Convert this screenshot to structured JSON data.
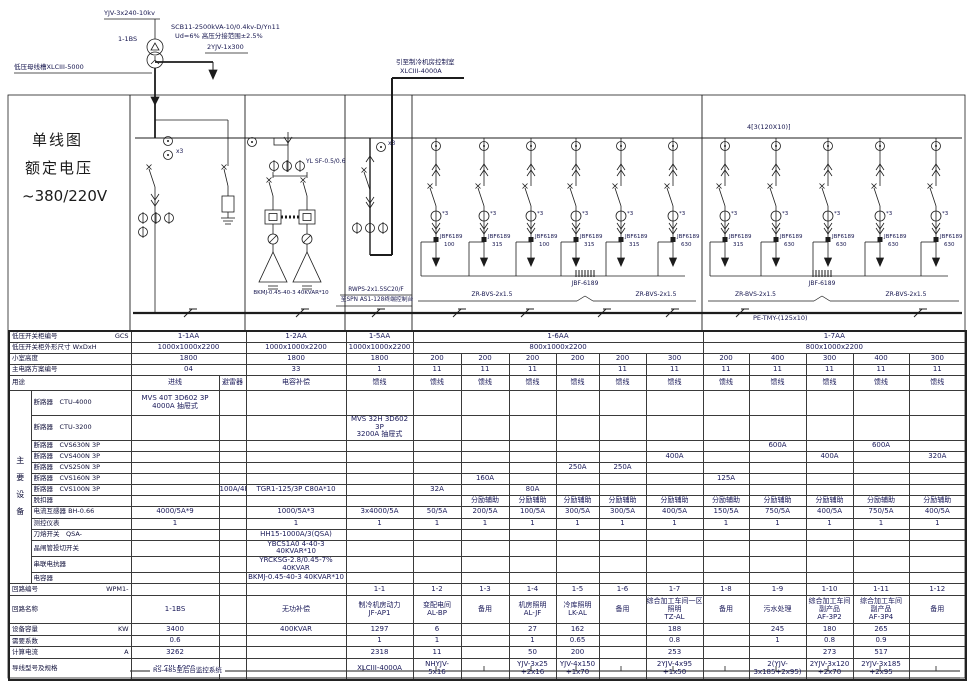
{
  "top": {
    "cable_hv": "YJV-3x240-10kv",
    "transformer_id": "1-1BS",
    "transformer_spec1": "SCB11-2500kVA-10/0.4kv-D/Yn11",
    "transformer_spec2": "Ud=6%  高压分接范围±2.5%",
    "cable_n": "2YJV-1x300",
    "busway": "低压母线槽XLCIII-5000",
    "to_chiller_1": "引至制冷机房控制室",
    "to_chiller_2": "XLCIII-4000A"
  },
  "panel_title": {
    "l1": "单线图",
    "l2": "额定电压",
    "l3": "~380/220V"
  },
  "schematic": {
    "meter_x3": "x3",
    "ct_x3": "*3",
    "yl_label": "YL SF-0.5/0.6",
    "cap_bottom_label": "BKMJ-0.45-40-3 40KVAR*10",
    "rwps_1": "RWPS-2x1.5SC20/F",
    "rwps_2": "至SPN AS1-128终端控制台",
    "zr_bvs": "ZR-BVS-2x1.5",
    "jbf_brace": "JBF-6189",
    "breaker_model": "JBF6189",
    "pe_bus": "PE-TMY-(125x10)",
    "bus_label_17aa": "4[3(120X10)]",
    "feeder_units_16aa": [
      "100",
      "315",
      "100",
      "315",
      "315",
      "630"
    ],
    "feeder_units_17aa": [
      "315",
      "630",
      "630",
      "630",
      "630"
    ]
  },
  "table": {
    "group_label": "主\n要\n设\n备",
    "col_widths": [
      22,
      100,
      88,
      27,
      100,
      67,
      48,
      48,
      47,
      43,
      47,
      57,
      46,
      57,
      47,
      56,
      57
    ],
    "rows": [
      {
        "h": 11,
        "label": "低压开关柜编号",
        "sub": "GCS",
        "cells": [
          [
            "1-1AA",
            2
          ],
          "1-2AA",
          "1-5AA",
          [
            "1-6AA",
            6
          ],
          [
            "1-7AA",
            5
          ]
        ]
      },
      {
        "h": 11,
        "label": "低压开关柜外形尺寸 WxDxH",
        "cells": [
          [
            "1000x1000x2200",
            2
          ],
          "1000x1000x2200",
          "1000x1000x2200",
          [
            "800x1000x2200",
            6
          ],
          [
            "800x1000x2200",
            5
          ]
        ]
      },
      {
        "h": 11,
        "label": "小室高度",
        "cells": [
          [
            "1800",
            2
          ],
          "1800",
          "1800",
          "200",
          "200",
          "200",
          "200",
          "200",
          "300",
          "200",
          "400",
          "300",
          "400",
          "300"
        ]
      },
      {
        "h": 11,
        "label": "主电路方案编号",
        "cells": [
          [
            "04",
            2
          ],
          "33",
          "1",
          "11",
          "11",
          "11",
          "",
          "11",
          "11",
          "11",
          "11",
          "11",
          "11",
          "11"
        ]
      },
      {
        "h": 15,
        "label": "用途",
        "cells": [
          "进线",
          "避雷器",
          "电容补偿",
          "馈线",
          "馈线",
          "馈线",
          "馈线",
          "馈线",
          "馈线",
          "馈线",
          "馈线",
          "馈线",
          "馈线",
          "馈线",
          "馈线"
        ]
      },
      {
        "h": 25,
        "g": true,
        "label": "断路器　CTU-4000",
        "cells": [
          "MVS 40T 3D602 3P\n4000A 抽屉式",
          "",
          "",
          "",
          "",
          "",
          "",
          "",
          "",
          "",
          "",
          "",
          "",
          "",
          ""
        ]
      },
      {
        "h": 25,
        "g": true,
        "label": "断路器　CTU-3200",
        "cells": [
          "",
          "",
          "",
          "MVS 32H 3D602 3P\n3200A 抽屉式",
          "",
          "",
          "",
          "",
          "",
          "",
          "",
          "",
          "",
          "",
          ""
        ]
      },
      {
        "h": 11,
        "g": true,
        "label": "断路器　CVS630N 3P",
        "cells": [
          "",
          "",
          "",
          "",
          "",
          "",
          "",
          "",
          "",
          "",
          "",
          "600A",
          "",
          "600A",
          ""
        ]
      },
      {
        "h": 11,
        "g": true,
        "label": "断路器　CVS400N 3P",
        "cells": [
          "",
          "",
          "",
          "",
          "",
          "",
          "",
          "",
          "",
          "400A",
          "",
          "",
          "400A",
          "",
          "320A"
        ]
      },
      {
        "h": 11,
        "g": true,
        "label": "断路器　CVS250N 3P",
        "cells": [
          "",
          "",
          "",
          "",
          "",
          "",
          "",
          "250A",
          "250A",
          "",
          "",
          "",
          "",
          "",
          ""
        ]
      },
      {
        "h": 11,
        "g": true,
        "label": "断路器　CVS160N 3P",
        "cells": [
          "",
          "",
          "",
          "",
          "",
          "160A",
          "",
          "",
          "",
          "",
          "125A",
          "",
          "",
          "",
          ""
        ]
      },
      {
        "h": 11,
        "g": true,
        "label": "断路器　CVS100N 3P",
        "cells": [
          "",
          "100A/4P",
          "TGR1-125/3P C80A*10",
          "",
          "32A",
          "",
          "80A",
          "",
          "",
          "",
          "",
          "",
          "",
          "",
          ""
        ]
      },
      {
        "h": 11,
        "g": true,
        "label": "脱扣器",
        "cells": [
          "",
          "",
          "",
          "",
          "",
          "分励辅助",
          "分励辅助",
          "分励辅助",
          "分励辅助",
          "分励辅助",
          "分励辅助",
          "分励辅助",
          "分励辅助",
          "分励辅助",
          "分励辅助"
        ]
      },
      {
        "h": 12,
        "g": true,
        "label": "电流互感器 BH-0.66",
        "cells": [
          "4000/5A*9",
          "",
          "1000/5A*3",
          "3x4000/5A",
          "50/5A",
          "200/5A",
          "100/5A",
          "300/5A",
          "300/5A",
          "400/5A",
          "150/5A",
          "750/5A",
          "400/5A",
          "750/5A",
          "400/5A"
        ]
      },
      {
        "h": 11,
        "g": true,
        "label": "测控仪表",
        "cells": [
          "1",
          "",
          "1",
          "1",
          "1",
          "1",
          "1",
          "1",
          "1",
          "1",
          "1",
          "1",
          "1",
          "1",
          "1"
        ]
      },
      {
        "h": 11,
        "g": true,
        "label": "刀熔开关　QSA-",
        "cells": [
          "",
          "",
          "HH15-1000A/3(QSA)",
          "",
          "",
          "",
          "",
          "",
          "",
          "",
          "",
          "",
          "",
          "",
          ""
        ]
      },
      {
        "h": 11,
        "g": true,
        "label": "晶闸管投切开关",
        "cells": [
          "",
          "",
          "YBCS1A0 4-40-3 40KVAR*10",
          "",
          "",
          "",
          "",
          "",
          "",
          "",
          "",
          "",
          "",
          "",
          ""
        ]
      },
      {
        "h": 11,
        "g": true,
        "label": "串联电抗器",
        "cells": [
          "",
          "",
          "YRCKSG-2.8/0.45-7% 40KVAR",
          "",
          "",
          "",
          "",
          "",
          "",
          "",
          "",
          "",
          "",
          "",
          ""
        ]
      },
      {
        "h": 11,
        "g": true,
        "label": "电容器",
        "cells": [
          "",
          "",
          "BKMJ-0.45-40-3 40KVAR*10",
          "",
          "",
          "",
          "",
          "",
          "",
          "",
          "",
          "",
          "",
          "",
          ""
        ]
      },
      {
        "h": 12,
        "label": "回路编号",
        "sub": "WPM1-",
        "cells": [
          "",
          "",
          "",
          "1-1",
          "1-2",
          "1-3",
          "1-4",
          "1-5",
          "1-6",
          "1-7",
          "1-8",
          "1-9",
          "1-10",
          "1-11",
          "1-12"
        ]
      },
      {
        "h": 28,
        "label": "回路名称",
        "cells": [
          "1-1BS",
          "",
          "无功补偿",
          "制冷机房动力\nJF-AP1",
          "变配电间\nAL-BP",
          "备用",
          "机房照明\nAL-JF",
          "冷库照明\nLK-AL",
          "备用",
          "综合加工车间一区\n照明\nTZ-AL",
          "备用",
          "污水处理",
          "综合加工车间\n副产品\nAF-3P2",
          "综合加工车间\n副产品\nAF-3P4",
          "备用"
        ]
      },
      {
        "h": 12,
        "label": "设备容量",
        "sub": "KW",
        "cells": [
          "3400",
          "",
          "400KVAR",
          "1297",
          "6",
          "",
          "27",
          "162",
          "",
          "188",
          "",
          "245",
          "180",
          "265",
          ""
        ]
      },
      {
        "h": 11,
        "label": "需要系数",
        "cells": [
          "0.6",
          "",
          "",
          "1",
          "1",
          "",
          "1",
          "0.65",
          "",
          "0.8",
          "",
          "1",
          "0.8",
          "0.9",
          ""
        ]
      },
      {
        "h": 12,
        "label": "计算电流",
        "sub": "A",
        "cells": [
          "3262",
          "",
          "",
          "2318",
          "11",
          "",
          "50",
          "200",
          "",
          "253",
          "",
          "",
          "273",
          "517",
          ""
        ]
      },
      {
        "h": 21,
        "label": "导线型号及规格",
        "cells": [
          "XLCIII-5000",
          "",
          "",
          "XLCIII-4000A",
          "NHYJV-\n5x16",
          "",
          "YJV-3x25\n+2x16",
          "YJV-4x150\n+1x70",
          "",
          "2YJV-4x95\n+1x50",
          "",
          "2(YJV-3x185+2x95)",
          "2YJV-3x120\n+2x70",
          "2YJV-3x185\n+2x95",
          ""
        ]
      }
    ]
  },
  "footer": {
    "rs485": "RS-485至后台监控系统"
  }
}
